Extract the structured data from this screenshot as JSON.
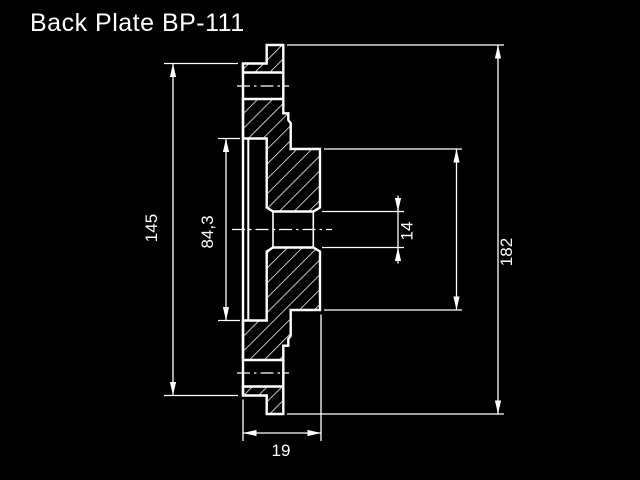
{
  "title": "Back Plate BP-111",
  "colors": {
    "background": "#000000",
    "line": "#ffffff"
  },
  "dimensions": {
    "face_diameter": {
      "label": "145"
    },
    "register_diameter": {
      "label": "84,3"
    },
    "bore_diameter": {
      "label": "14"
    },
    "outer_diameter": {
      "label": "182"
    },
    "thickness": {
      "label": "19"
    },
    "hub_diameter": {
      "label": ""
    }
  }
}
